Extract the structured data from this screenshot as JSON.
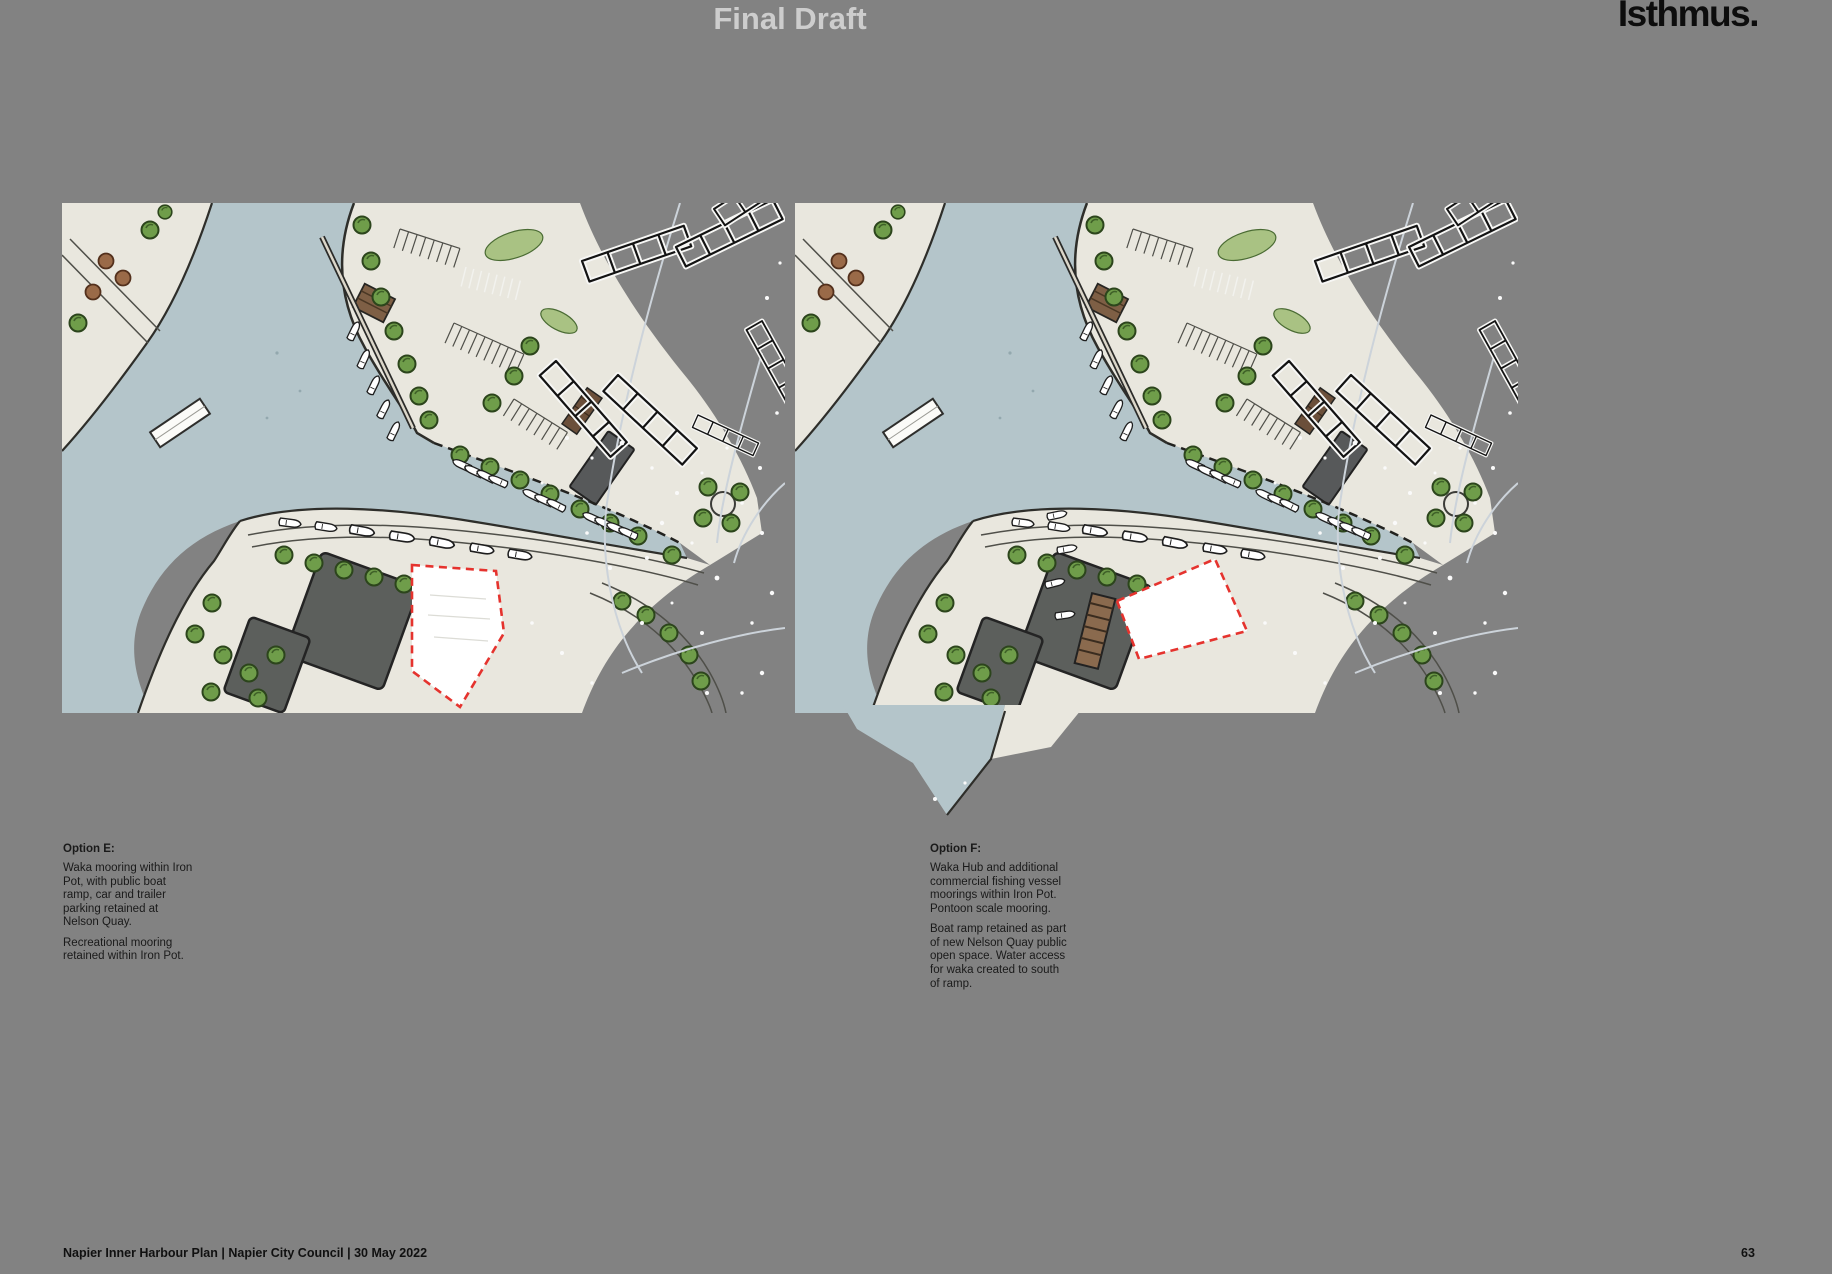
{
  "page": {
    "title": "Final Draft",
    "brand": "Isthmus.",
    "footer": "Napier Inner Harbour Plan | Napier City Council | 30 May 2022",
    "page_number": "63"
  },
  "options": [
    {
      "id": "E",
      "heading": "Option E:",
      "paragraphs": [
        "Waka mooring within Iron Pot, with public boat ramp, car and trailer parking retained at Nelson Quay.",
        "Recreational mooring retained within Iron Pot."
      ],
      "map_label": "Illustrated aerial plan of Napier Inner Harbour - Option E"
    },
    {
      "id": "F",
      "heading": "Option F:",
      "paragraphs": [
        "Waka Hub and additional commercial fishing vessel moorings within Iron Pot. Pontoon scale mooring.",
        "Boat ramp retained as part of new Nelson Quay public open space. Water access for waka created to south of ramp."
      ],
      "map_label": "Illustrated aerial plan of Napier Inner Harbour - Option F"
    }
  ],
  "colors": {
    "background": "#828282",
    "water": "#b4c5ca",
    "land": "#e9e7de",
    "tree_green": "#6f9d4a",
    "lawn": "#a9c283",
    "shed_dark": "#5c5f5c",
    "pier_brown": "#8a6a4e",
    "site_boundary_red": "#e5332e",
    "site_fill": "#ffffff"
  }
}
